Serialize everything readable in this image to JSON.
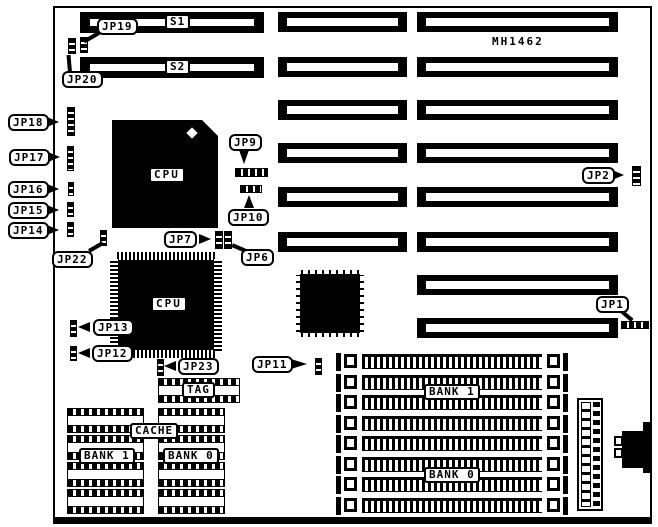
{
  "diagram": {
    "model": "MH1462"
  },
  "labels": {
    "s1": "S1",
    "s2": "S2",
    "cpu1": "CPU",
    "cpu2": "CPU",
    "tag": "TAG",
    "cache": "CACHE",
    "dip_bank1": "BANK 1",
    "dip_bank0": "BANK 0",
    "simm_bank1": "BANK 1",
    "simm_bank0": "BANK 0"
  },
  "jumpers": {
    "jp1": "JP1",
    "jp2": "JP2",
    "jp6": "JP6",
    "jp7": "JP7",
    "jp9": "JP9",
    "jp10": "JP10",
    "jp11": "JP11",
    "jp12": "JP12",
    "jp13": "JP13",
    "jp14": "JP14",
    "jp15": "JP15",
    "jp16": "JP16",
    "jp17": "JP17",
    "jp18": "JP18",
    "jp19": "JP19",
    "jp20": "JP20",
    "jp22": "JP22",
    "jp23": "JP23"
  },
  "colors": {
    "ink": "#000000",
    "paper": "#ffffff"
  }
}
